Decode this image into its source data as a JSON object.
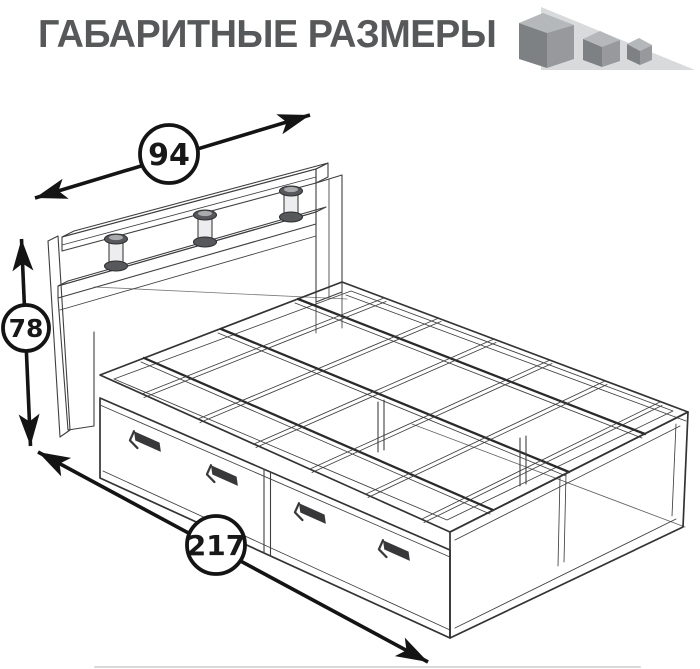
{
  "header": {
    "title": "ГАБАРИТНЫЕ РАЗМЕРЫ",
    "title_color": "#57585a"
  },
  "logo": {
    "icon": "three-cubes-logo",
    "triangle_color": "#d9dadb",
    "cube_top_color": "#b5b8ba",
    "cube_left_color": "#7e8184",
    "cube_right_color": "#97999c"
  },
  "diagram": {
    "description": "Isometric wireframe drawing of a bed with headboard shelf on cylindrical posts and two under-bed drawers with pull handles",
    "line_color": "#3f3f42",
    "dimensions": {
      "width": {
        "value": "94"
      },
      "height": {
        "value": "78"
      },
      "length": {
        "value": "217"
      }
    }
  }
}
